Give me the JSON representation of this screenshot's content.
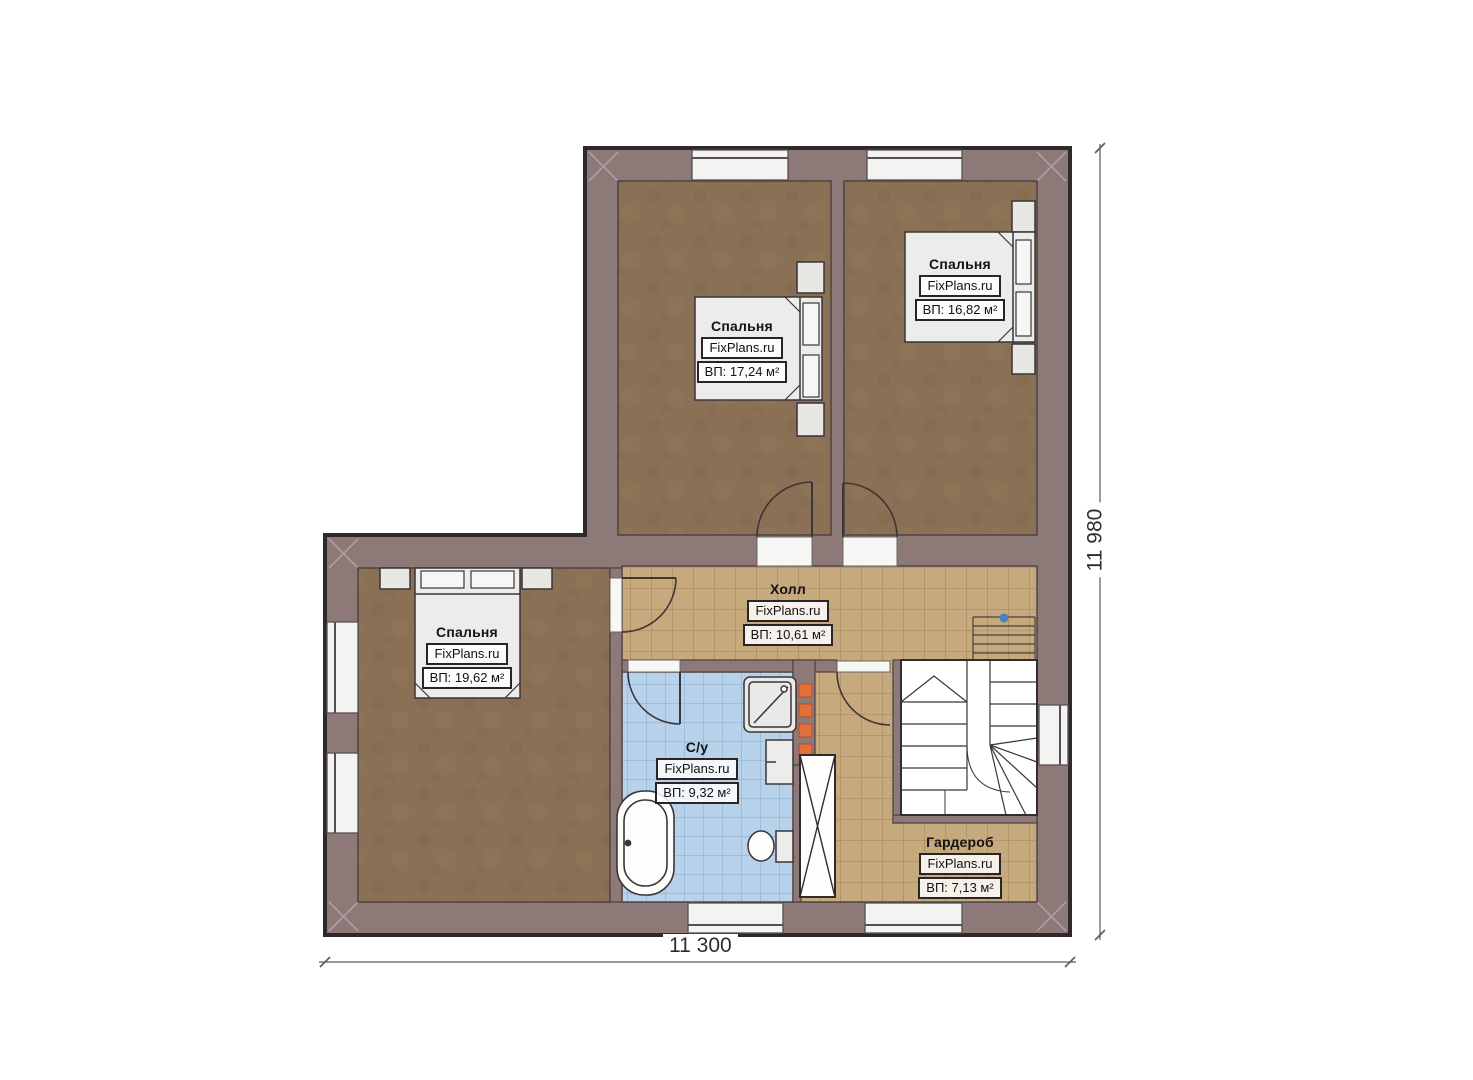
{
  "branding": {
    "watermark": "FixPlans.ru"
  },
  "plan": {
    "type": "floor-plan",
    "dimensions": {
      "width_label": "11 300",
      "height_label": "11 980"
    }
  },
  "rooms": [
    {
      "id": "bedroom-top-left",
      "name": "Спальня",
      "area": "ВП: 17,24 м²"
    },
    {
      "id": "bedroom-top-right",
      "name": "Спальня",
      "area": "ВП: 16,82 м²"
    },
    {
      "id": "bedroom-bottom-left",
      "name": "Спальня",
      "area": "ВП: 19,62 м²"
    },
    {
      "id": "hall",
      "name": "Холл",
      "area": "ВП: 10,61 м²"
    },
    {
      "id": "bathroom",
      "name": "С/у",
      "area": "ВП: 9,32 м²"
    },
    {
      "id": "wardrobe",
      "name": "Гардероб",
      "area": "ВП: 7,13 м²"
    }
  ],
  "colors": {
    "wall": "#8e7979",
    "wall_outline": "#2f292b",
    "bedroom_floor": "#8a7155",
    "tile_floor": "#c6a97c",
    "tile_grid": "#a08257",
    "bath_floor": "#b7d2ea",
    "bath_grid": "#86aed2",
    "furniture": "#ececea",
    "radiator_accent": "#e2703d",
    "stair_marker": "#4b80b8"
  }
}
